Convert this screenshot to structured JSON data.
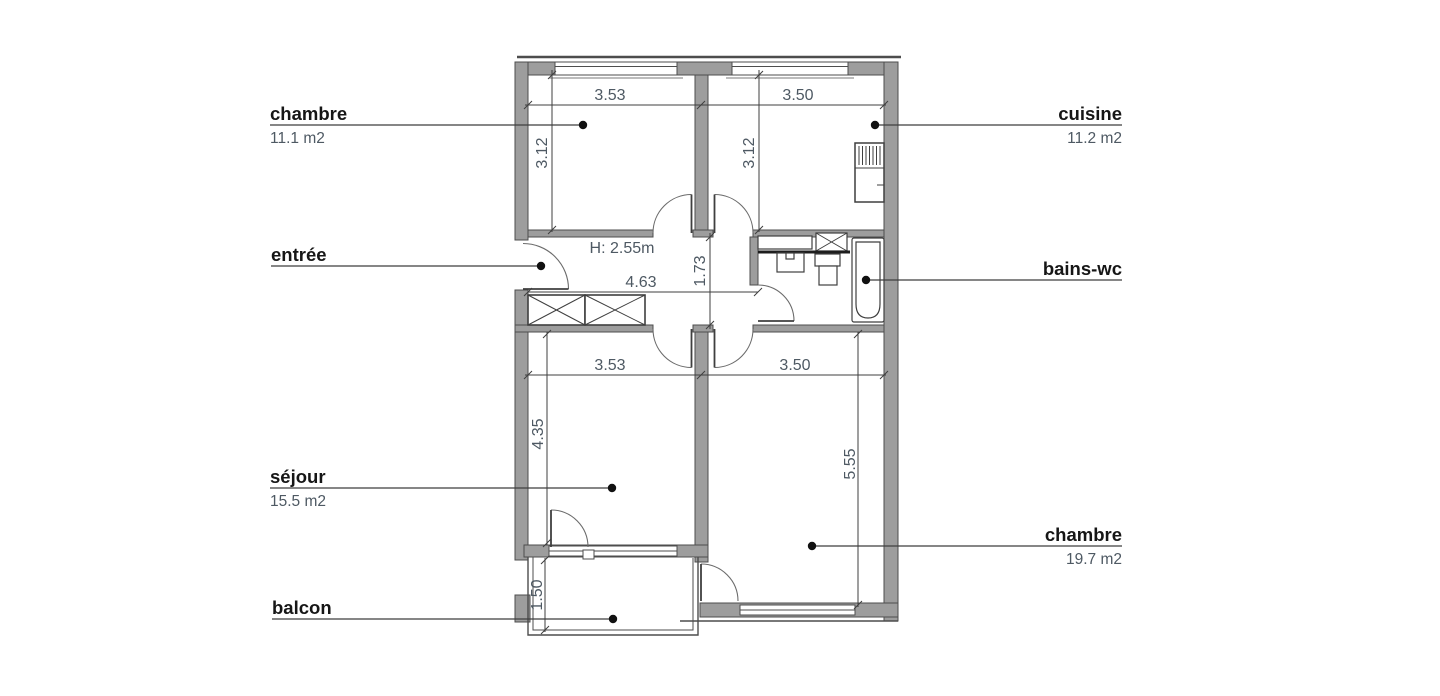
{
  "rooms": {
    "bedroom1": {
      "name": "chambre",
      "area": "11.1 m2"
    },
    "kitchen": {
      "name": "cuisine",
      "area": "11.2 m2"
    },
    "entry": {
      "name": "entrée"
    },
    "bath": {
      "name": "bains-wc"
    },
    "living": {
      "name": "séjour",
      "area": "15.5 m2"
    },
    "bedroom2": {
      "name": "chambre",
      "area": "19.7 m2"
    },
    "balcony": {
      "name": "balcon"
    }
  },
  "dims": {
    "top_left_width": "3.53",
    "top_right_width": "3.50",
    "top_left_height": "3.12",
    "top_right_height": "3.12",
    "hall_width": "4.63",
    "hall_depth": "1.73",
    "ceiling_height": "H: 2.55m",
    "bottom_left_width": "3.53",
    "bottom_right_width": "3.50",
    "living_height": "4.35",
    "bedroom2_height": "5.55",
    "balcony_depth": "1.50"
  },
  "colors": {
    "wall_fill": "#9d9d9d",
    "wall_stroke": "#4d4d4d",
    "line": "#3f3f3f",
    "label_text": "#161616",
    "dim_text": "#4e5963",
    "background": "#ffffff"
  }
}
